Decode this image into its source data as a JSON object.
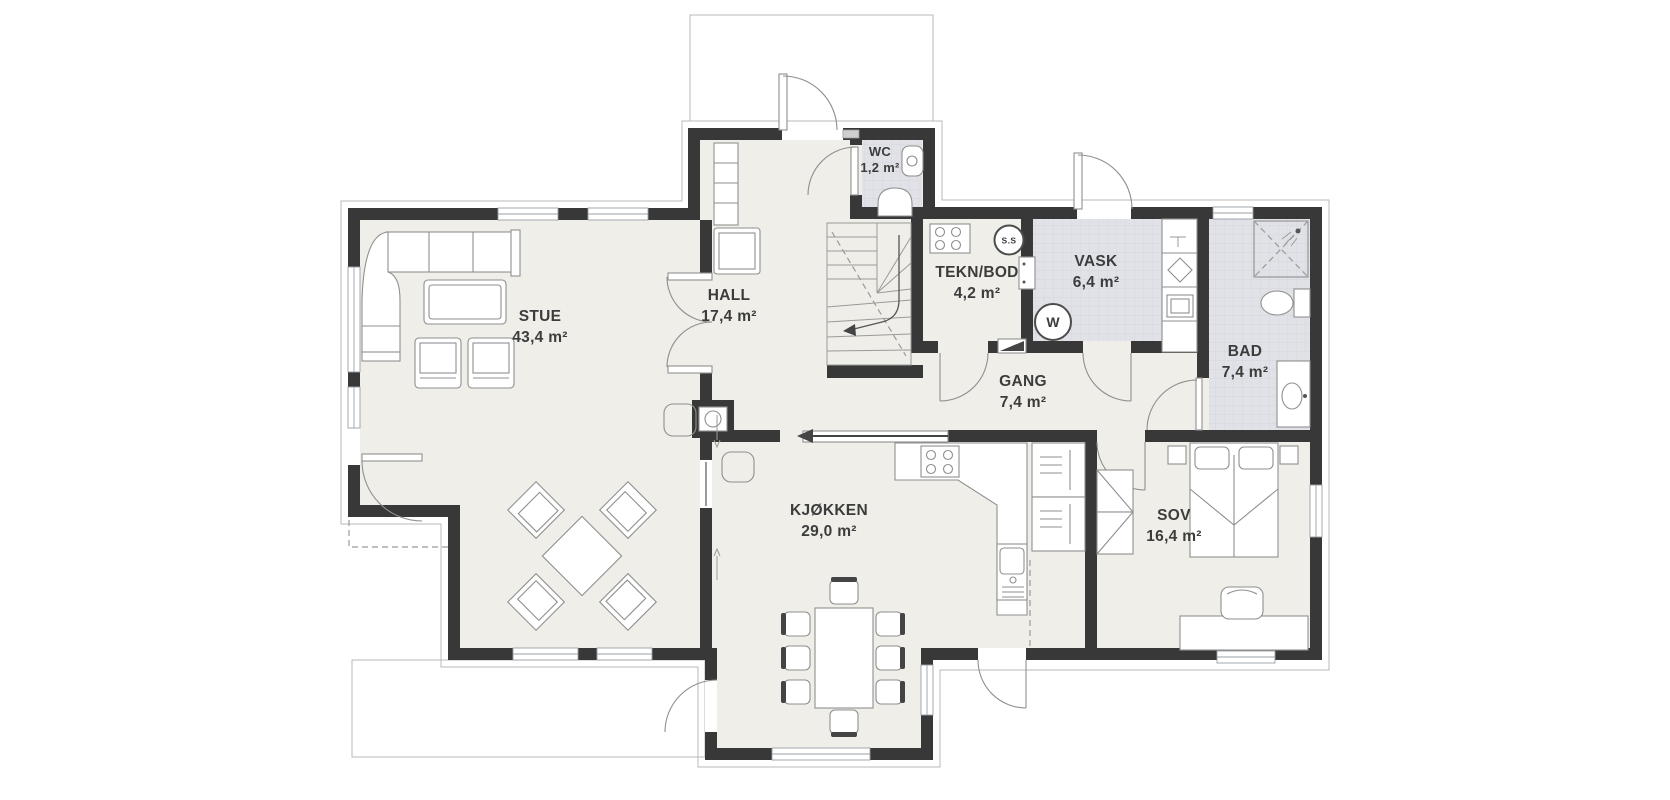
{
  "figure": {
    "type": "house floor plan",
    "floor": "main floor",
    "language": "Norwegian"
  },
  "rooms": [
    {
      "id": "stue",
      "name": "STUE",
      "area": "43,4 m²"
    },
    {
      "id": "hall",
      "name": "HALL",
      "area": "17,4 m²"
    },
    {
      "id": "wc",
      "name": "WC",
      "area": "1,2 m²"
    },
    {
      "id": "tekn-bod",
      "name": "TEKN/BOD",
      "area": "4,2 m²"
    },
    {
      "id": "vask",
      "name": "VASK",
      "area": "6,4 m²"
    },
    {
      "id": "bad",
      "name": "BAD",
      "area": "7,4 m²"
    },
    {
      "id": "gang",
      "name": "GANG",
      "area": "7,4 m²"
    },
    {
      "id": "kjokken",
      "name": "KJØKKEN",
      "area": "29,0 m²"
    },
    {
      "id": "sov",
      "name": "SOV",
      "area": "16,4 m²"
    }
  ],
  "symbols": {
    "washing_machine": "W",
    "central_vacuum": "S.S"
  },
  "colors": {
    "wall": "#383838",
    "floor": "#efeee8",
    "wet_floor": "#e0e2e7",
    "furniture_line": "#8f8f8f",
    "outline": "#b9b9b9",
    "text": "#3c3c3c",
    "background": "#ffffff"
  }
}
